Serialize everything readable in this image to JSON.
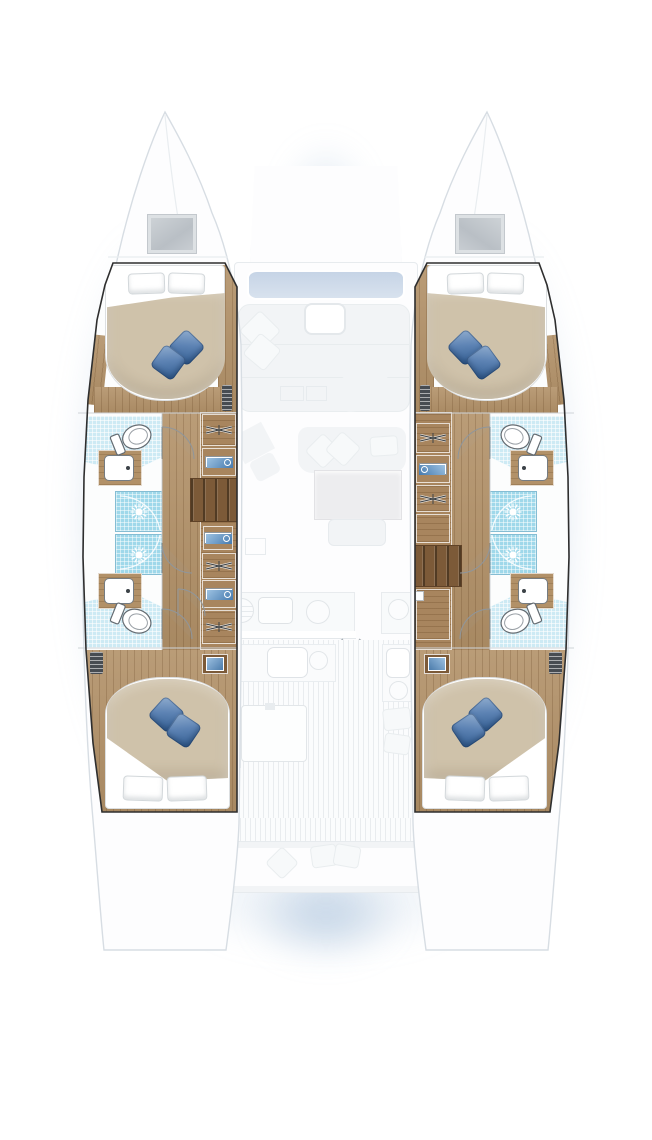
{
  "plan": {
    "view": "Catamaran yacht deck plan, top-down view, 4 cabins and 4 heads",
    "vessel_type": "sailing catamaran",
    "port_hull": {
      "bow_hatch": "deck hatch",
      "forward_cabin": {
        "bed": "island double berth",
        "white_pillows": 2,
        "blue_accent_pillows": 2,
        "vent": "louver grille"
      },
      "forward_head": {
        "fixtures": [
          "toilet",
          "vanity sink",
          "tiled shower"
        ]
      },
      "aft_head": {
        "fixtures": [
          "toilet",
          "vanity sink",
          "tiled shower"
        ]
      },
      "companionway": "steps amidships between heads",
      "storage_column": [
        "hanging locker",
        "towel shelves",
        "companionway steps",
        "towel shelf",
        "hanging locker",
        "towel shelves",
        "hanging locker"
      ],
      "aft_cabin": {
        "bed": "double berth",
        "white_pillows": 2,
        "blue_accent_pillows": 2,
        "vent": "louver grille",
        "nightstand": "blue basin"
      }
    },
    "starboard_hull": {
      "bow_hatch": "deck hatch",
      "forward_cabin": {
        "bed": "island double berth",
        "white_pillows": 2,
        "blue_accent_pillows": 2,
        "vent": "louver grille"
      },
      "forward_head": {
        "fixtures": [
          "toilet",
          "vanity sink",
          "tiled shower"
        ]
      },
      "aft_head": {
        "fixtures": [
          "toilet",
          "vanity sink",
          "tiled shower"
        ]
      },
      "companionway": "steps aft of heads",
      "storage_column": [
        "hanging locker",
        "towel shelves",
        "hanging locker",
        "locker",
        "companionway steps",
        "locker"
      ],
      "aft_cabin": {
        "bed": "double berth",
        "white_pillows": 2,
        "blue_accent_pillows": 2,
        "vent": "louver grille",
        "nightstand": "blue basin"
      }
    },
    "bridgedeck_ghosted": {
      "foredeck": [
        "foredeck panel",
        "coachroof window band",
        "forward cockpit lounge",
        "cocktail table",
        "scatter cushions"
      ],
      "salon": [
        "nav station",
        "sofa with cushions",
        "dining table",
        "bench"
      ],
      "galley": [
        "grill",
        "double sink",
        "burner",
        "side counter with burner",
        "sliding-door arrow"
      ],
      "aft_cockpit": [
        "wet bar sink",
        "burner",
        "cockpit table",
        "side seat cushions",
        "stern bench with cushions"
      ],
      "transom": [
        "port swim platform",
        "starboard swim platform"
      ]
    }
  },
  "icons": {
    "shower_head": "sun-rays",
    "clothes_hanger": "crossed-hanger",
    "sliding_door": "double-arrow",
    "towel_shelf": "blue-stack-with-swirl",
    "louver_vent": "slatted-grille",
    "stove_burner": "ghost-circle",
    "toilet": "oval-bowl-with-seat"
  },
  "colors": {
    "glow": "#9bb7d4",
    "wood": "#b29168",
    "steps": "#7c5a38",
    "tile": "#cdeaf4",
    "shower": "#9fd8ea",
    "duvet": "#cfc2aa",
    "pillow_blue": "#5d83b4",
    "outline": "#2e2e2e",
    "ghost": "#f2f4f6",
    "window": "#c6d4e6"
  }
}
